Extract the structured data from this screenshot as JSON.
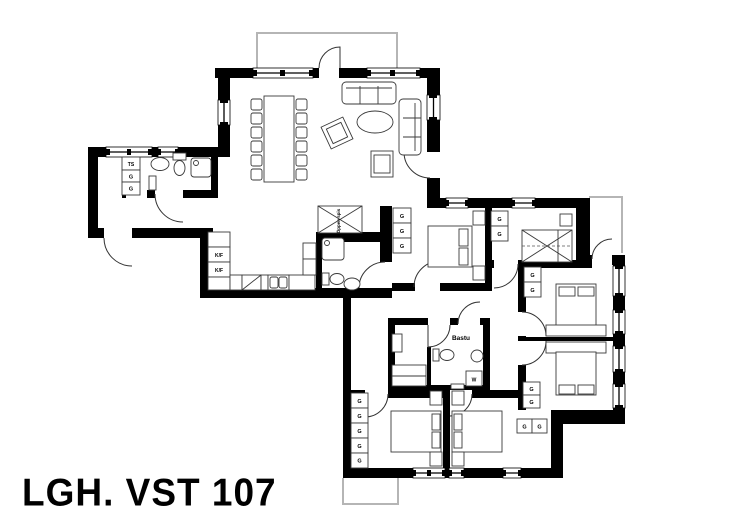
{
  "title": "LGH. VST 107",
  "colors": {
    "wall": "#000000",
    "furniture_line": "#3a3a3a",
    "exterior_outline": "#b5b5b5"
  },
  "labels": [
    {
      "id": "ts-cabinet",
      "text": "TS",
      "x": 131,
      "y": 166,
      "size": 5
    },
    {
      "id": "g-bathroom-1",
      "text": "G",
      "x": 131,
      "y": 178.5,
      "size": 5.5
    },
    {
      "id": "g-bathroom-2",
      "text": "G",
      "x": 131,
      "y": 190.5,
      "size": 5.5
    },
    {
      "id": "kf-fridge",
      "text": "K/F",
      "x": 219,
      "y": 257,
      "size": 5
    },
    {
      "id": "kf-freezer",
      "text": "K/F",
      "x": 219,
      "y": 272,
      "size": 5
    },
    {
      "id": "oppen-spis",
      "text": "Öppen spis",
      "x": 340,
      "y": 221,
      "size": 4.5,
      "rot": -90
    },
    {
      "id": "g-bedroom-a-1",
      "text": "G",
      "x": 402,
      "y": 218,
      "size": 5.5
    },
    {
      "id": "g-bedroom-a-2",
      "text": "G",
      "x": 402,
      "y": 233,
      "size": 5.5
    },
    {
      "id": "g-bedroom-a-3",
      "text": "G",
      "x": 402,
      "y": 248,
      "size": 5.5
    },
    {
      "id": "g-bedroom-b-1",
      "text": "G",
      "x": 499.5,
      "y": 221,
      "size": 5.5
    },
    {
      "id": "g-bedroom-b-2",
      "text": "G",
      "x": 499.5,
      "y": 236,
      "size": 5.5
    },
    {
      "id": "g-bedroom-c-1",
      "text": "G",
      "x": 532.5,
      "y": 277,
      "size": 5.5
    },
    {
      "id": "g-bedroom-c-2",
      "text": "G",
      "x": 532.5,
      "y": 292,
      "size": 5.5
    },
    {
      "id": "g-bedroom-d-1",
      "text": "G",
      "x": 531.5,
      "y": 391,
      "size": 5.5
    },
    {
      "id": "g-bedroom-d-2",
      "text": "G",
      "x": 531.5,
      "y": 404,
      "size": 5.5
    },
    {
      "id": "g-bedroom-f-1",
      "text": "G",
      "x": 524.5,
      "y": 428.5,
      "size": 5.5
    },
    {
      "id": "g-bedroom-f-2",
      "text": "G",
      "x": 539.5,
      "y": 428.5,
      "size": 5.5
    },
    {
      "id": "g-bedroom-e-1",
      "text": "G",
      "x": 359.5,
      "y": 403,
      "size": 5.5
    },
    {
      "id": "g-bedroom-e-2",
      "text": "G",
      "x": 359.5,
      "y": 418,
      "size": 5.5
    },
    {
      "id": "g-bedroom-e-3",
      "text": "G",
      "x": 359.5,
      "y": 433,
      "size": 5.5
    },
    {
      "id": "g-bedroom-e-4",
      "text": "G",
      "x": 359.5,
      "y": 448,
      "size": 5.5
    },
    {
      "id": "g-bedroom-e-5",
      "text": "G",
      "x": 359.5,
      "y": 462.5,
      "size": 5.5
    },
    {
      "id": "washer",
      "text": "W",
      "x": 474,
      "y": 381.5,
      "size": 5
    },
    {
      "id": "bastu",
      "text": "Bastu",
      "x": 461,
      "y": 340,
      "size": 6.5
    }
  ]
}
